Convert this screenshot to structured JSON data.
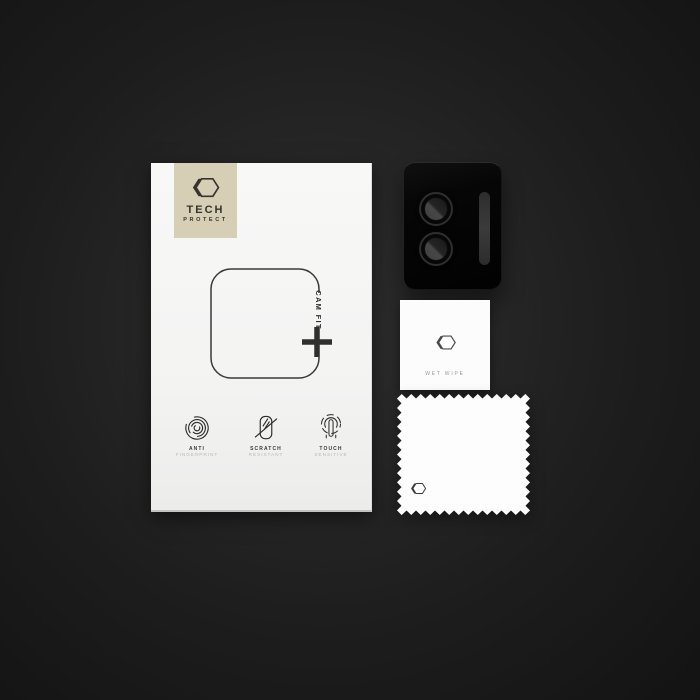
{
  "product": {
    "brand": {
      "name": "TECH",
      "subname": "PROTECT"
    },
    "package": {
      "fit_label": "CAM FIT",
      "features": [
        {
          "icon": "fingerprint-icon",
          "line1": "ANTI",
          "line2": "FINGERPRINT"
        },
        {
          "icon": "scratch-icon",
          "line1": "SCRATCH",
          "line2": "RESISTANT"
        },
        {
          "icon": "touch-icon",
          "line1": "TOUCH",
          "line2": "SENSITIVE"
        }
      ]
    },
    "accessories": {
      "camera_protector": {
        "lens_count": 2
      },
      "wet_wipe": {
        "label": "WET WIPE"
      },
      "microfiber_cloth": {
        "label": ""
      }
    }
  },
  "colors": {
    "background_center": "#2d2d2d",
    "background_edge": "#131313",
    "card": "#f6f6f5",
    "logo_box": "#d7ceb6",
    "ink": "#35342e",
    "muted_text": "#b9b9b9",
    "module_black": "#060606",
    "lens_gray": "#3f3f3f",
    "wipe_white": "#fcfcfc"
  }
}
